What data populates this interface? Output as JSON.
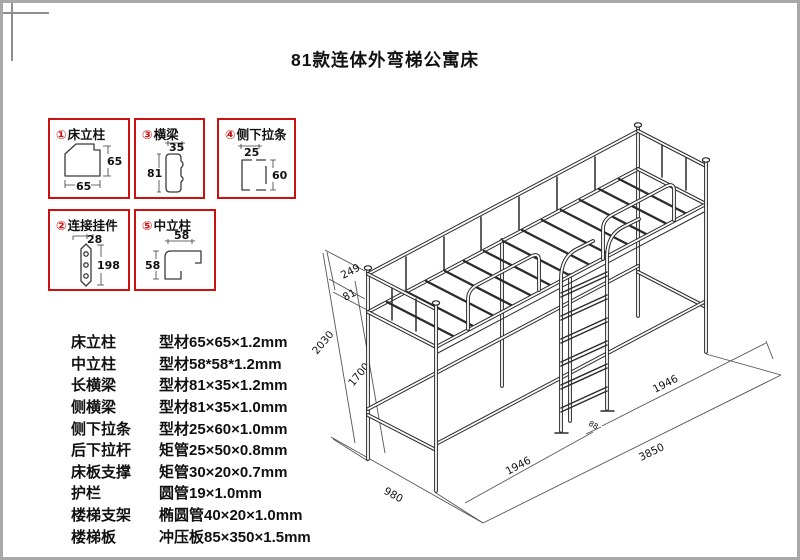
{
  "title": "81款连体外弯梯公寓床",
  "legend": {
    "boxes": [
      {
        "num": "①",
        "name": "床立柱",
        "dim_right": "65",
        "dim_bottom": "65"
      },
      {
        "num": "③",
        "name": "横梁",
        "dim_top": "35",
        "dim_left": "81"
      },
      {
        "num": "④",
        "name": "侧下拉条",
        "dim_top": "25",
        "dim_right": "60"
      },
      {
        "num": "②",
        "name": "连接挂件",
        "dim_top": "28",
        "dim_right": "198"
      },
      {
        "num": "⑤",
        "name": "中立柱",
        "dim_top": "58",
        "dim_left": "58"
      }
    ]
  },
  "specs": {
    "rows": [
      {
        "part": "床立柱",
        "spec": "型材65×65×1.2mm"
      },
      {
        "part": "中立柱",
        "spec": "型材58*58*1.2mm"
      },
      {
        "part": "长横梁",
        "spec": "型材81×35×1.2mm"
      },
      {
        "part": "侧横梁",
        "spec": "型材81×35×1.0mm"
      },
      {
        "part": "侧下拉条",
        "spec": "型材25×60×1.0mm"
      },
      {
        "part": "后下拉杆",
        "spec": "矩管25×50×0.8mm"
      },
      {
        "part": "床板支撑",
        "spec": "矩管30×20×0.7mm"
      },
      {
        "part": "护栏",
        "spec": "圆管19×1.0mm"
      },
      {
        "part": "楼梯支架",
        "spec": "椭圆管40×20×1.0mm"
      },
      {
        "part": "楼梯板",
        "spec": "冲压板85×350×1.5mm"
      }
    ]
  },
  "drawing": {
    "dims": {
      "guard_upper": "249",
      "guard_lower": "81",
      "overall_height": "2030",
      "deck_height": "1700",
      "bed_len_left": "1946",
      "bed_len_right": "1946",
      "overall_length": "3850",
      "overall_width": "980",
      "ladder_offset": "88"
    }
  },
  "colors": {
    "accent_red": "#cc1111",
    "line": "#2b2b2b"
  }
}
